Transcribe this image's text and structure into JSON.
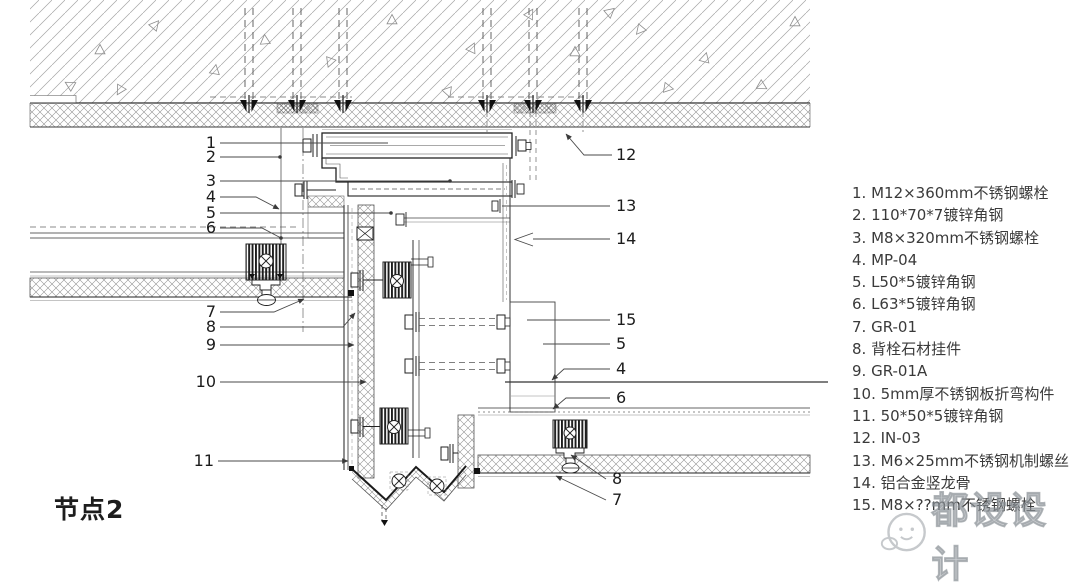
{
  "title": "节点2",
  "legend": {
    "items": [
      "1. M12×360mm不锈钢螺栓",
      "2. 110*70*7镀锌角钢",
      "3. M8×320mm不锈钢螺栓",
      "4. MP-04",
      "5. L50*5镀锌角钢",
      "6. L63*5镀锌角钢",
      "7. GR-01",
      "8. 背栓石材挂件",
      "9. GR-01A",
      "10. 5mm厚不锈钢板折弯构件",
      "11. 50*50*5镀锌角钢",
      "12. IN-03",
      "13. M6×25mm不锈钢机制螺丝",
      "14. 铝合金竖龙骨",
      "15. M8×??mm不锈钢螺栓"
    ]
  },
  "callouts": {
    "left": [
      "1",
      "2",
      "3",
      "4",
      "5",
      "6",
      "7",
      "8",
      "9",
      "10",
      "11"
    ],
    "right": [
      "12",
      "13",
      "14",
      "15",
      "5",
      "4",
      "6",
      "8",
      "7"
    ]
  },
  "watermark": {
    "text": "都设设计",
    "logo_icon": "speech-bubble-face-logo"
  },
  "colors": {
    "background": "#ffffff",
    "line": "#333333",
    "hatch": "#9a9a9a",
    "text": "#3a3a3a",
    "watermark": "#9aa0a5"
  }
}
